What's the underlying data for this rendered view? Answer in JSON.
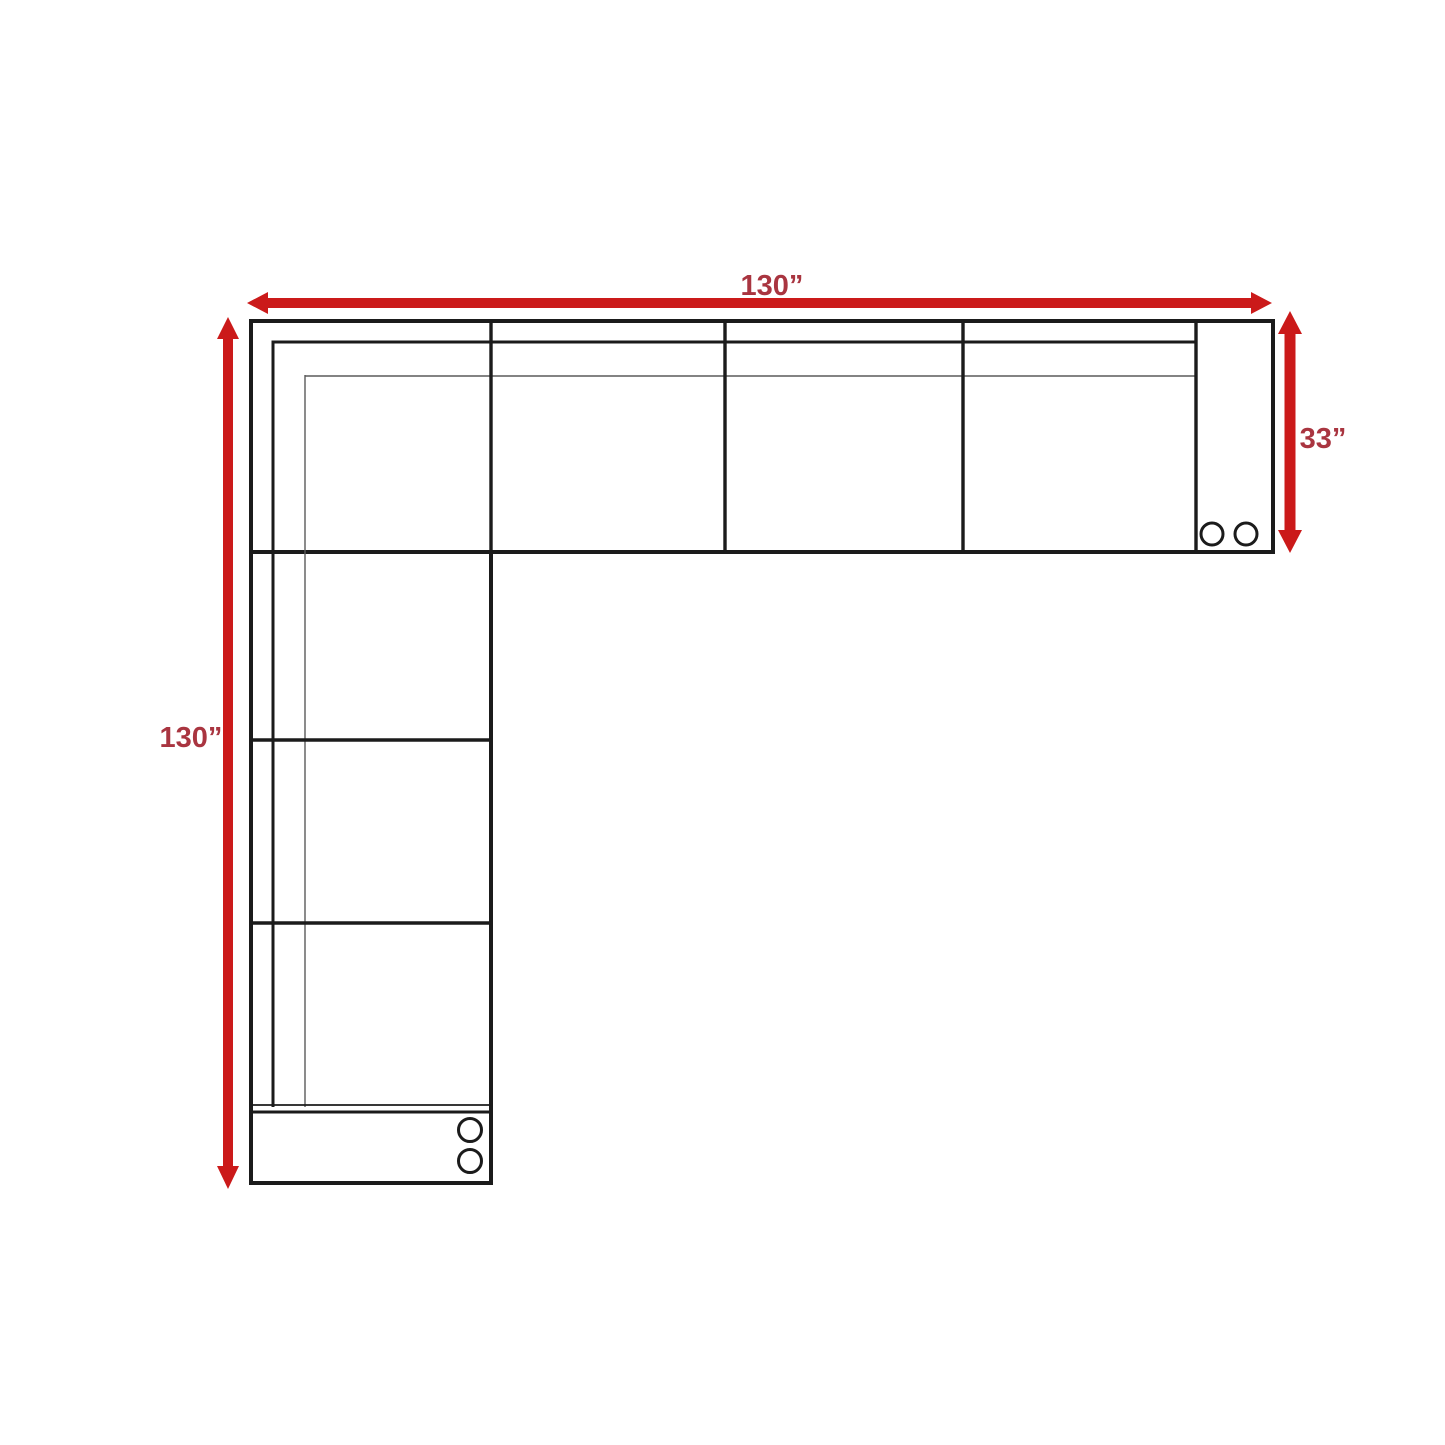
{
  "diagram": {
    "name": "sectional-sofa-dimension-plan",
    "description": "Top-view floor plan drawing of an L-shaped sectional sofa with red double-headed dimension arrows",
    "dimensions": [
      {
        "id": "overall-width",
        "label": "130”",
        "value": 130,
        "unit": "inches",
        "side": "top",
        "orientation": "horizontal"
      },
      {
        "id": "overall-length",
        "label": "130”",
        "value": 130,
        "unit": "inches",
        "side": "left",
        "orientation": "vertical"
      },
      {
        "id": "section-depth",
        "label": "33”",
        "value": 33,
        "unit": "inches",
        "side": "right",
        "orientation": "vertical"
      }
    ],
    "sofa": {
      "shape": "L-shaped sectional",
      "top_row_seat_cells": 4,
      "left_column_seat_cells": 4,
      "right_console_cupholders": 2,
      "bottom_console_cupholders": 2
    }
  },
  "colors": {
    "arrow_red": "#cb1a1a",
    "label_red": "#a93540",
    "line_dark": "#1b1b1b",
    "line_light": "#5a5a5a",
    "background": "#ffffff"
  }
}
